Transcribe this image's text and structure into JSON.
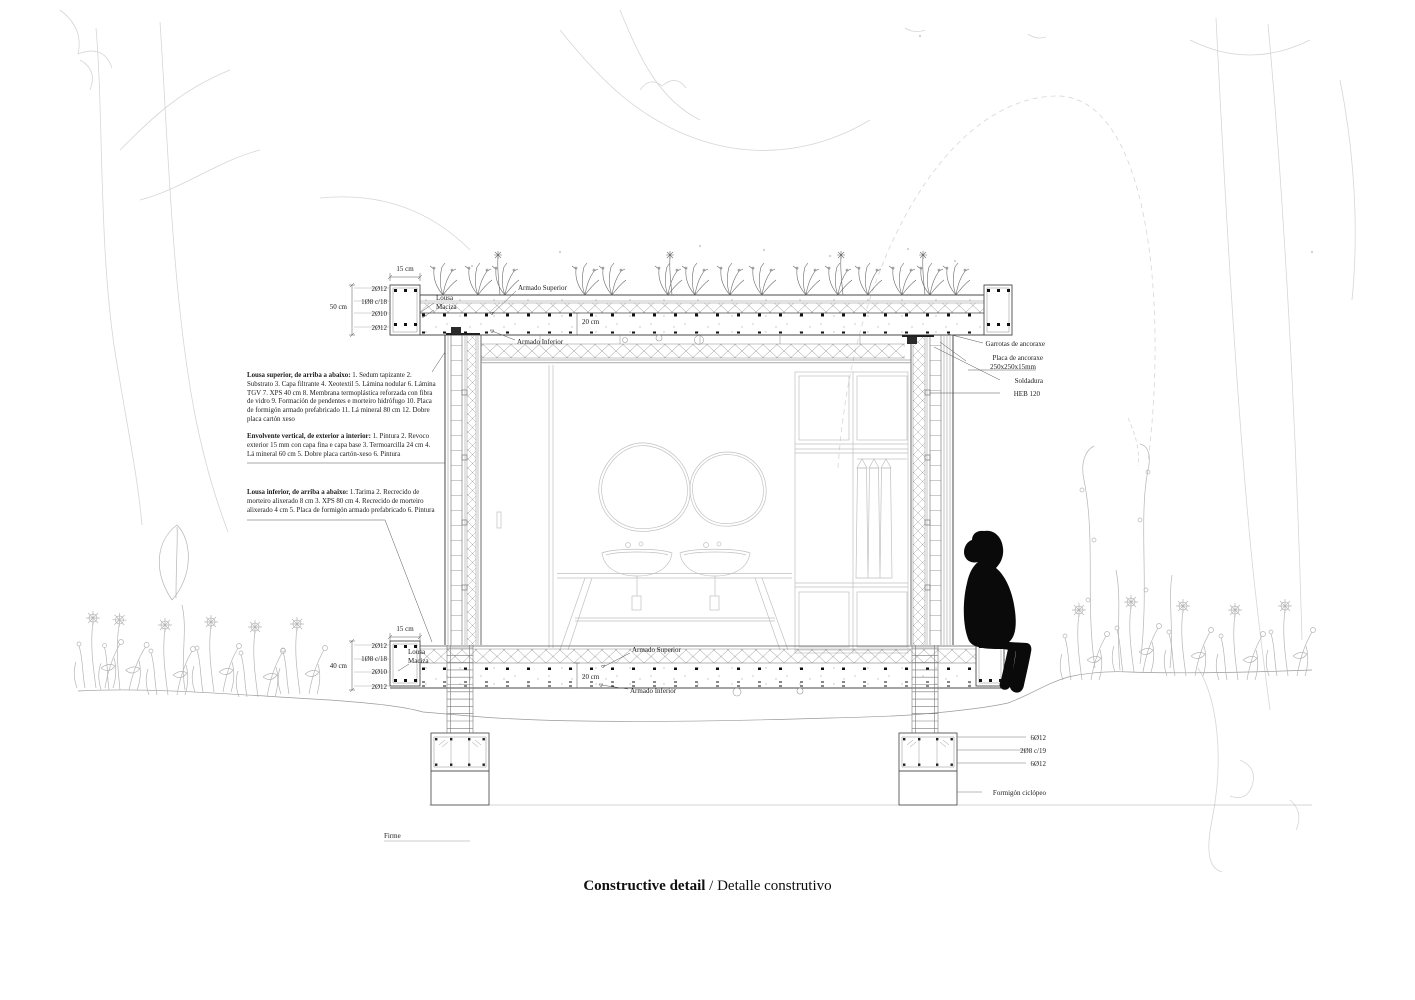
{
  "title": {
    "primary": "Constructive detail",
    "separator": " / ",
    "secondary": "Detalle construtivo"
  },
  "annotations": {
    "roof_assembly": {
      "heading": "Lousa superior, de arriba a abaixo:",
      "body": " 1. Sedum tapizante 2. Substrato 3. Capa filtrante 4. Xeotextil 5. Lámina nodular 6. Lámina TGV 7. XPS 40 cm 8. Membrana termoplástica reforzada con fibra de vidro 9. Formación de pendentes e morteiro hidrófugo 10. Placa de formigón armado prefabricado 11. Lá mineral 80 cm 12. Dobre placa cartón xeso"
    },
    "wall_assembly": {
      "heading": "Envolvente vertical, de exterior a interior:",
      "body": " 1. Pintura 2. Revoco exterior 15 mm con capa fina e capa base 3. Termoarcilla 24 cm 4. Lá mineral 60 cm 5. Dobre placa cartón-xeso 6. Pintura"
    },
    "floor_assembly": {
      "heading": "Lousa inferior, de arriba a abaixo:",
      "body": " 1.Tarima 2. Recrecido de morteiro alixerado 8 cm 3. XPS 80 cm 4. Recrecido de morteiro alixerado 4 cm 5. Placa de formigón armado prefabricado 6. Pintura"
    }
  },
  "roof_labels": {
    "dim_width": "15 cm",
    "dim_height": "50 cm",
    "rebar_1": "2Ø12",
    "rebar_2": "1Ø8 c/18",
    "rebar_3": "2Ø10",
    "rebar_4": "2Ø12",
    "slab_line1": "Lousa",
    "slab_line2": "Maciza",
    "top_reinforcement": "Armado Superior",
    "slab_depth": "20 cm",
    "bottom_reinforcement": "Armado Inferior"
  },
  "floor_labels": {
    "dim_width": "15 cm",
    "dim_height": "40 cm",
    "rebar_1": "2Ø12",
    "rebar_2": "1Ø8 c/18",
    "rebar_3": "2Ø10",
    "rebar_4": "2Ø12",
    "slab_line1": "Lousa",
    "slab_line2": "Maciza",
    "top_reinforcement": "Armado Superior",
    "slab_depth": "20 cm",
    "bottom_reinforcement": "Armado Inferior"
  },
  "anchor_labels": {
    "ties": "Garrotas de ancoraxe",
    "plate_line1": "Placa de ancoraxe",
    "plate_line2": "250x250x15mm",
    "weld": "Soldadura",
    "beam": "HEB 120"
  },
  "foundation_labels": {
    "rebar_top": "6Ø12",
    "rebar_stirrups": "2Ø8 c/19",
    "rebar_bottom": "6Ø12",
    "concrete": "Formigón ciclópeo",
    "ground": "Firme"
  }
}
